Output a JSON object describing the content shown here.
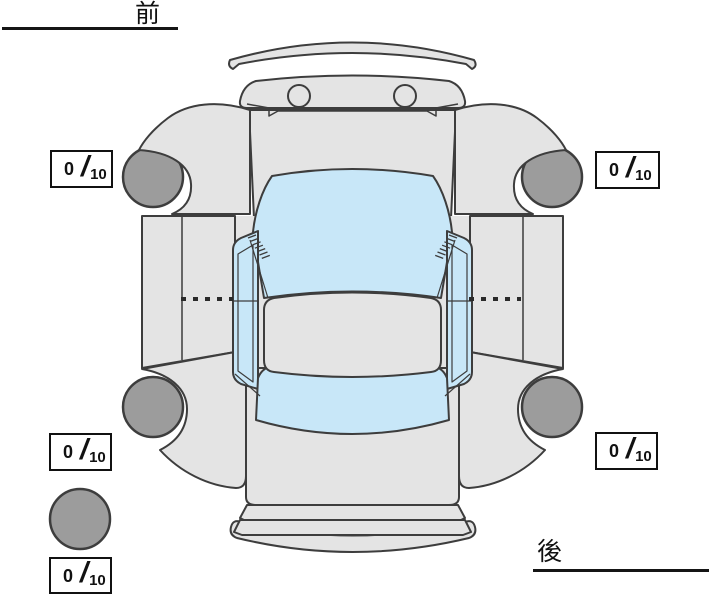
{
  "labels": {
    "front": "前",
    "rear": "後"
  },
  "scores": {
    "front_left": {
      "value": "0",
      "separator": "/",
      "max": "10"
    },
    "front_right": {
      "value": "0",
      "separator": "/",
      "max": "10"
    },
    "rear_left": {
      "value": "0",
      "separator": "/",
      "max": "10"
    },
    "rear_right": {
      "value": "0",
      "separator": "/",
      "max": "10"
    },
    "spare": {
      "value": "0",
      "separator": "/",
      "max": "10"
    }
  },
  "icons": {
    "car": "car-top-view-outline",
    "tire": "gray-circle",
    "spare_tire": "gray-circle"
  },
  "colors": {
    "body": "#e4e4e4",
    "glass": "#c8e7f8",
    "tire": "#9c9c9c",
    "outline": "#3d3d3d",
    "score_box_border": "#111111",
    "text": "#111111",
    "background": "#ffffff"
  }
}
